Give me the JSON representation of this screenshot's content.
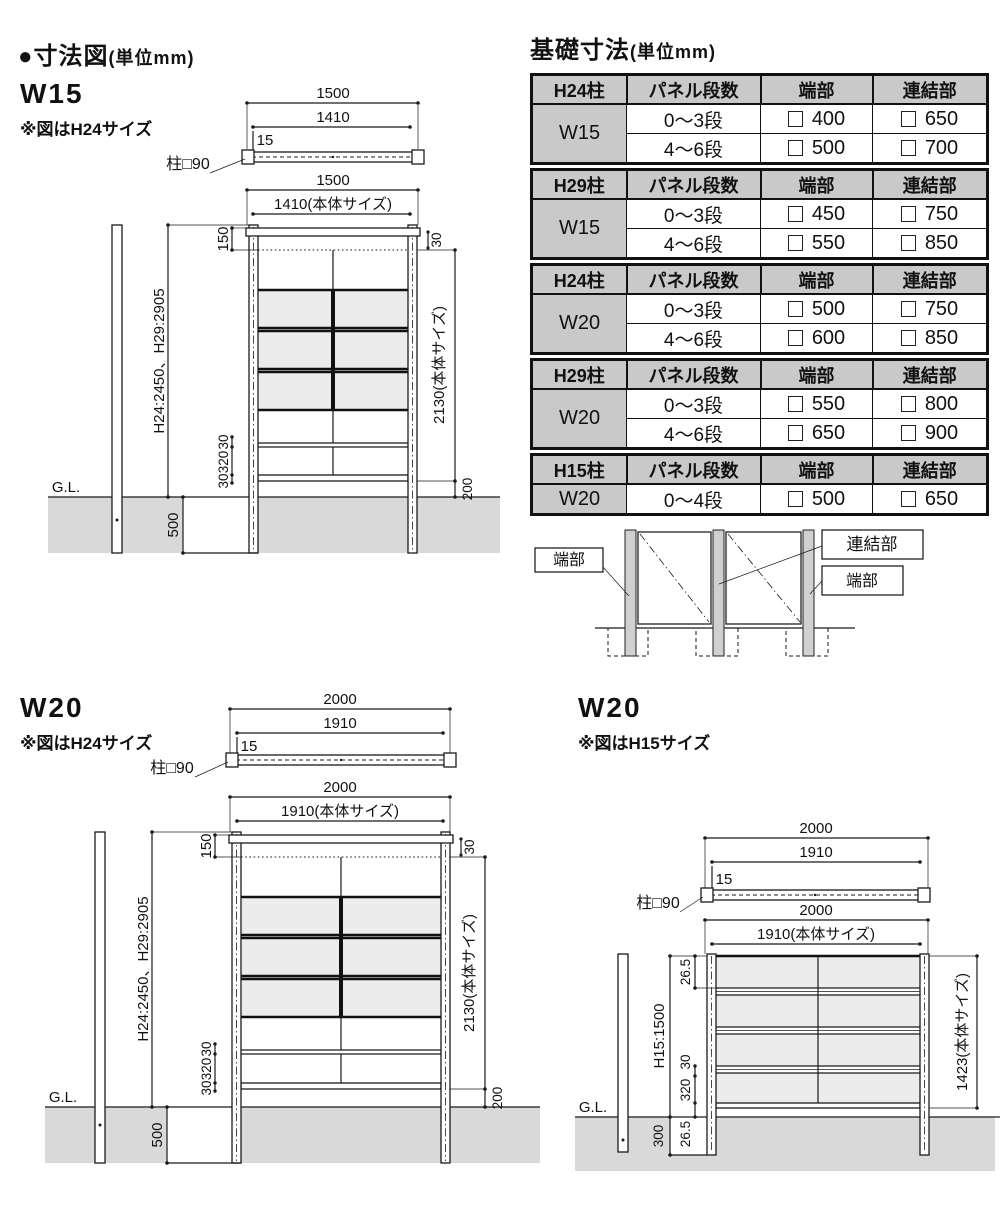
{
  "titles": {
    "left_main": "●寸法図",
    "left_unit": "(単位mm)",
    "right_main": "基礎寸法",
    "right_unit": "(単位mm)"
  },
  "headers": {
    "dan": "パネル段数",
    "tan": "端部",
    "ren": "連結部"
  },
  "tables": [
    {
      "post": "H24柱",
      "size": "W15",
      "rows": [
        {
          "dan": "0～3段",
          "tan": "400",
          "ren": "650"
        },
        {
          "dan": "4～6段",
          "tan": "500",
          "ren": "700"
        }
      ]
    },
    {
      "post": "H29柱",
      "size": "W15",
      "rows": [
        {
          "dan": "0～3段",
          "tan": "450",
          "ren": "750"
        },
        {
          "dan": "4～6段",
          "tan": "550",
          "ren": "850"
        }
      ]
    },
    {
      "post": "H24柱",
      "size": "W20",
      "rows": [
        {
          "dan": "0～3段",
          "tan": "500",
          "ren": "750"
        },
        {
          "dan": "4～6段",
          "tan": "600",
          "ren": "850"
        }
      ]
    },
    {
      "post": "H29柱",
      "size": "W20",
      "rows": [
        {
          "dan": "0～3段",
          "tan": "550",
          "ren": "800"
        },
        {
          "dan": "4～6段",
          "tan": "650",
          "ren": "900"
        }
      ]
    },
    {
      "post": "H15柱",
      "size": "W20",
      "rows": [
        {
          "dan": "0～4段",
          "tan": "500",
          "ren": "650"
        }
      ]
    }
  ],
  "legend": {
    "left": "端部",
    "middle": "連結部",
    "right": "端部"
  },
  "w15": {
    "label": "W15",
    "note": "※図はH24サイズ",
    "post_label": "柱□90",
    "plan": {
      "overall": "1500",
      "body": "1410",
      "offset": "15"
    },
    "elev": {
      "overall": "1500",
      "body": "1410(本体サイズ)",
      "top_gap": "150",
      "top_offset": "30",
      "post_height": "H24:2450、H29:2905",
      "body_height": "2130(本体サイズ)",
      "rail_top": "30",
      "rail_gap": "320",
      "rail_bot": "30",
      "clearance": "200",
      "embed": "500",
      "gl": "G.L."
    }
  },
  "w20h24": {
    "label": "W20",
    "note": "※図はH24サイズ",
    "post_label": "柱□90",
    "plan": {
      "overall": "2000",
      "body": "1910",
      "offset": "15"
    },
    "elev": {
      "overall": "2000",
      "body": "1910(本体サイズ)",
      "top_gap": "150",
      "top_offset": "30",
      "post_height": "H24:2450、H29:2905",
      "body_height": "2130(本体サイズ)",
      "rail_top": "30",
      "rail_gap": "320",
      "rail_bot": "30",
      "clearance": "200",
      "embed": "500",
      "gl": "G.L."
    }
  },
  "w20h15": {
    "label": "W20",
    "note": "※図はH15サイズ",
    "post_label": "柱□90",
    "plan": {
      "overall": "2000",
      "body": "1910",
      "offset": "15"
    },
    "elev": {
      "overall": "2000",
      "body": "1910(本体サイズ)",
      "top_gap": "26.5",
      "post_height": "H15:1500",
      "body_height": "1423(本体サイズ)",
      "rail_top": "30",
      "rail_gap": "320",
      "rail_bot": "26.5",
      "embed": "300",
      "gl": "G.L."
    }
  },
  "colors": {
    "table_header_bg": "#c9c9c9",
    "panel_fill": "#ececec",
    "ground_fill": "#d9d9d9",
    "line": "#1a1a1a"
  }
}
